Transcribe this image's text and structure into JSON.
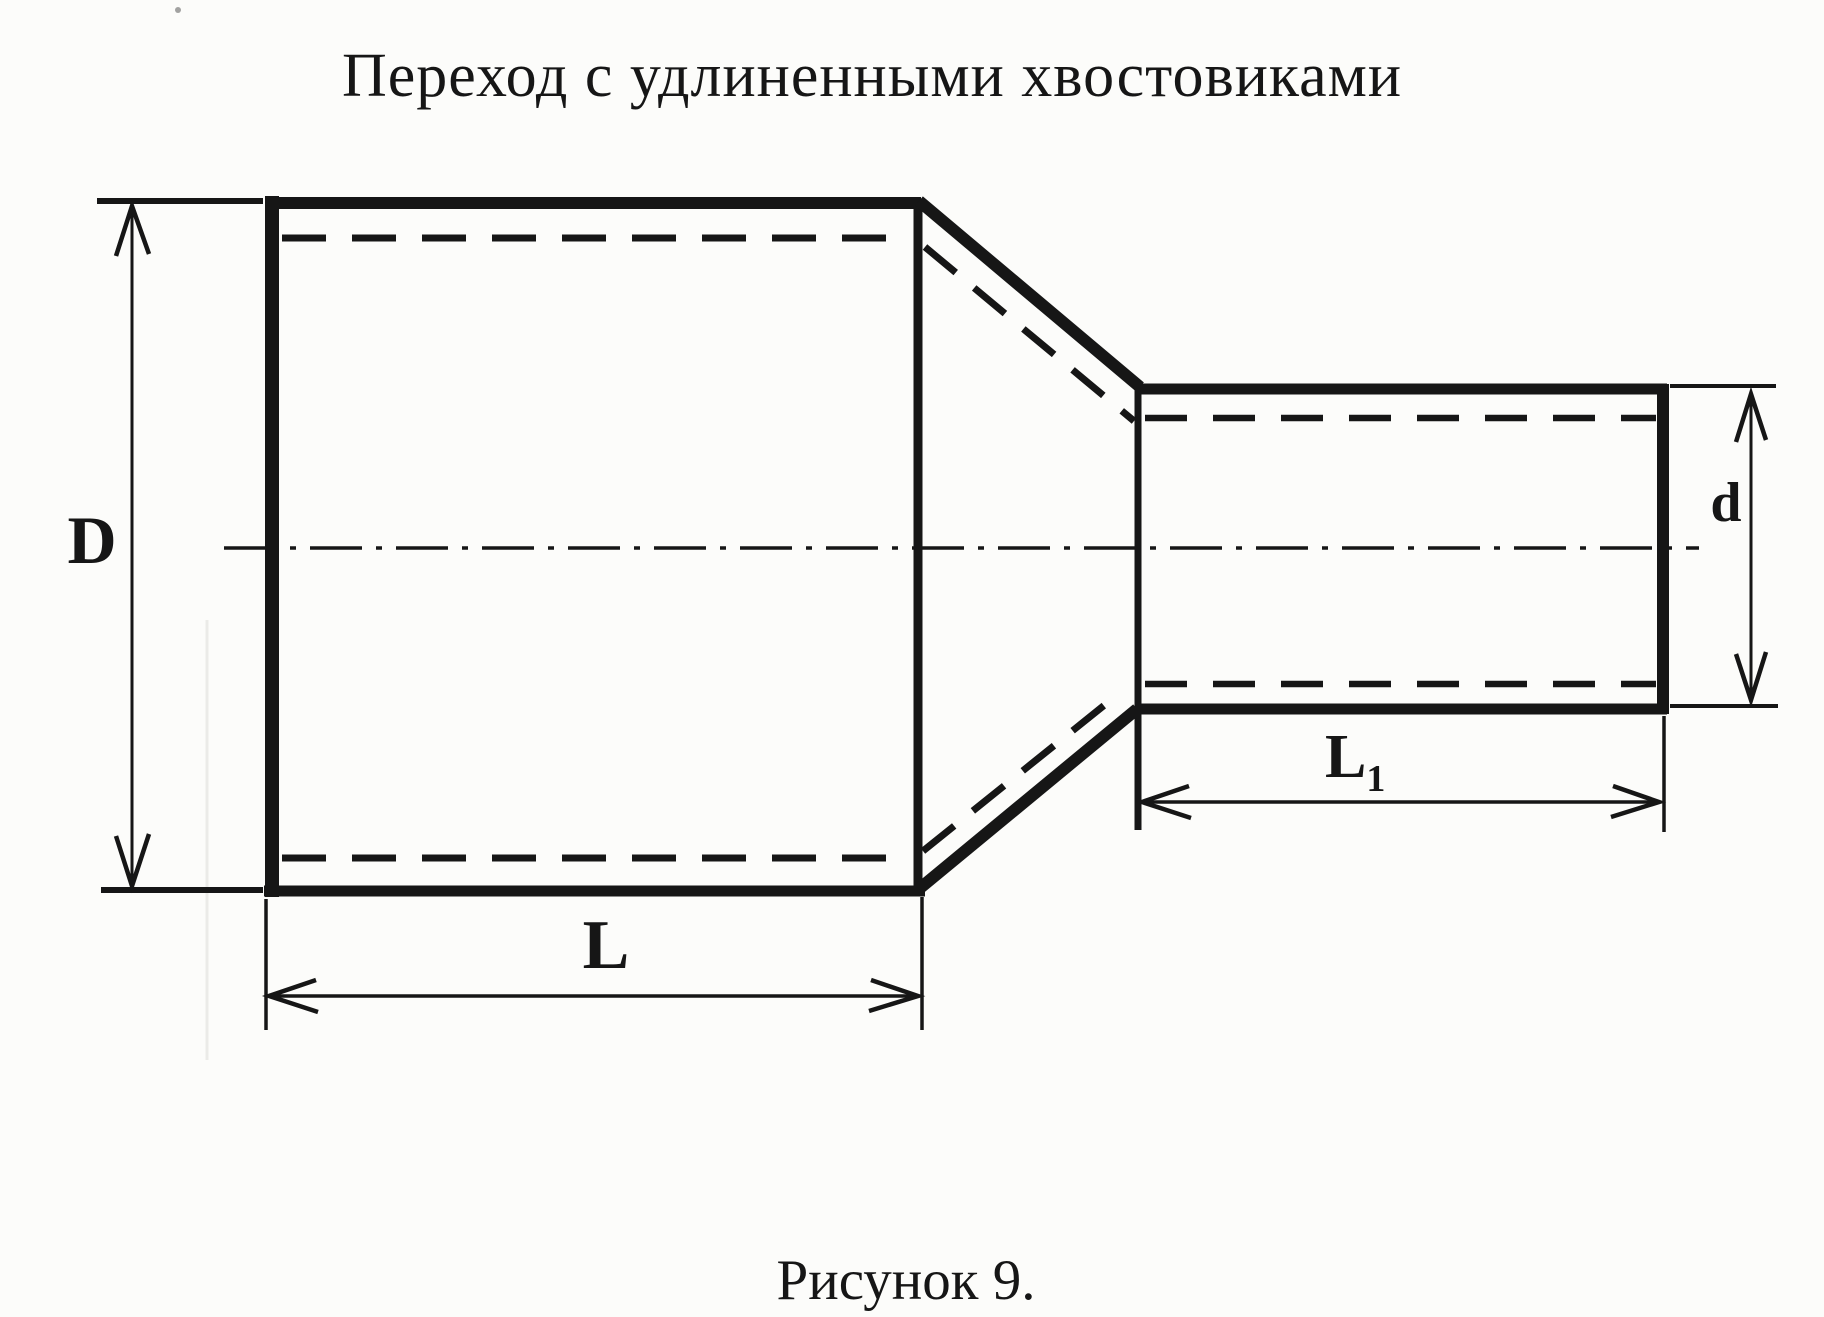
{
  "colors": {
    "paper": "#fcfcfa",
    "ink": "#161616"
  },
  "title": "Переход с удлиненными хвостовиками",
  "caption": "Рисунок 9.",
  "labels": {
    "outer_diameter": "D",
    "small_diameter": "d",
    "body_length": "L",
    "tail_length_base": "L",
    "tail_length_sub": "1"
  }
}
